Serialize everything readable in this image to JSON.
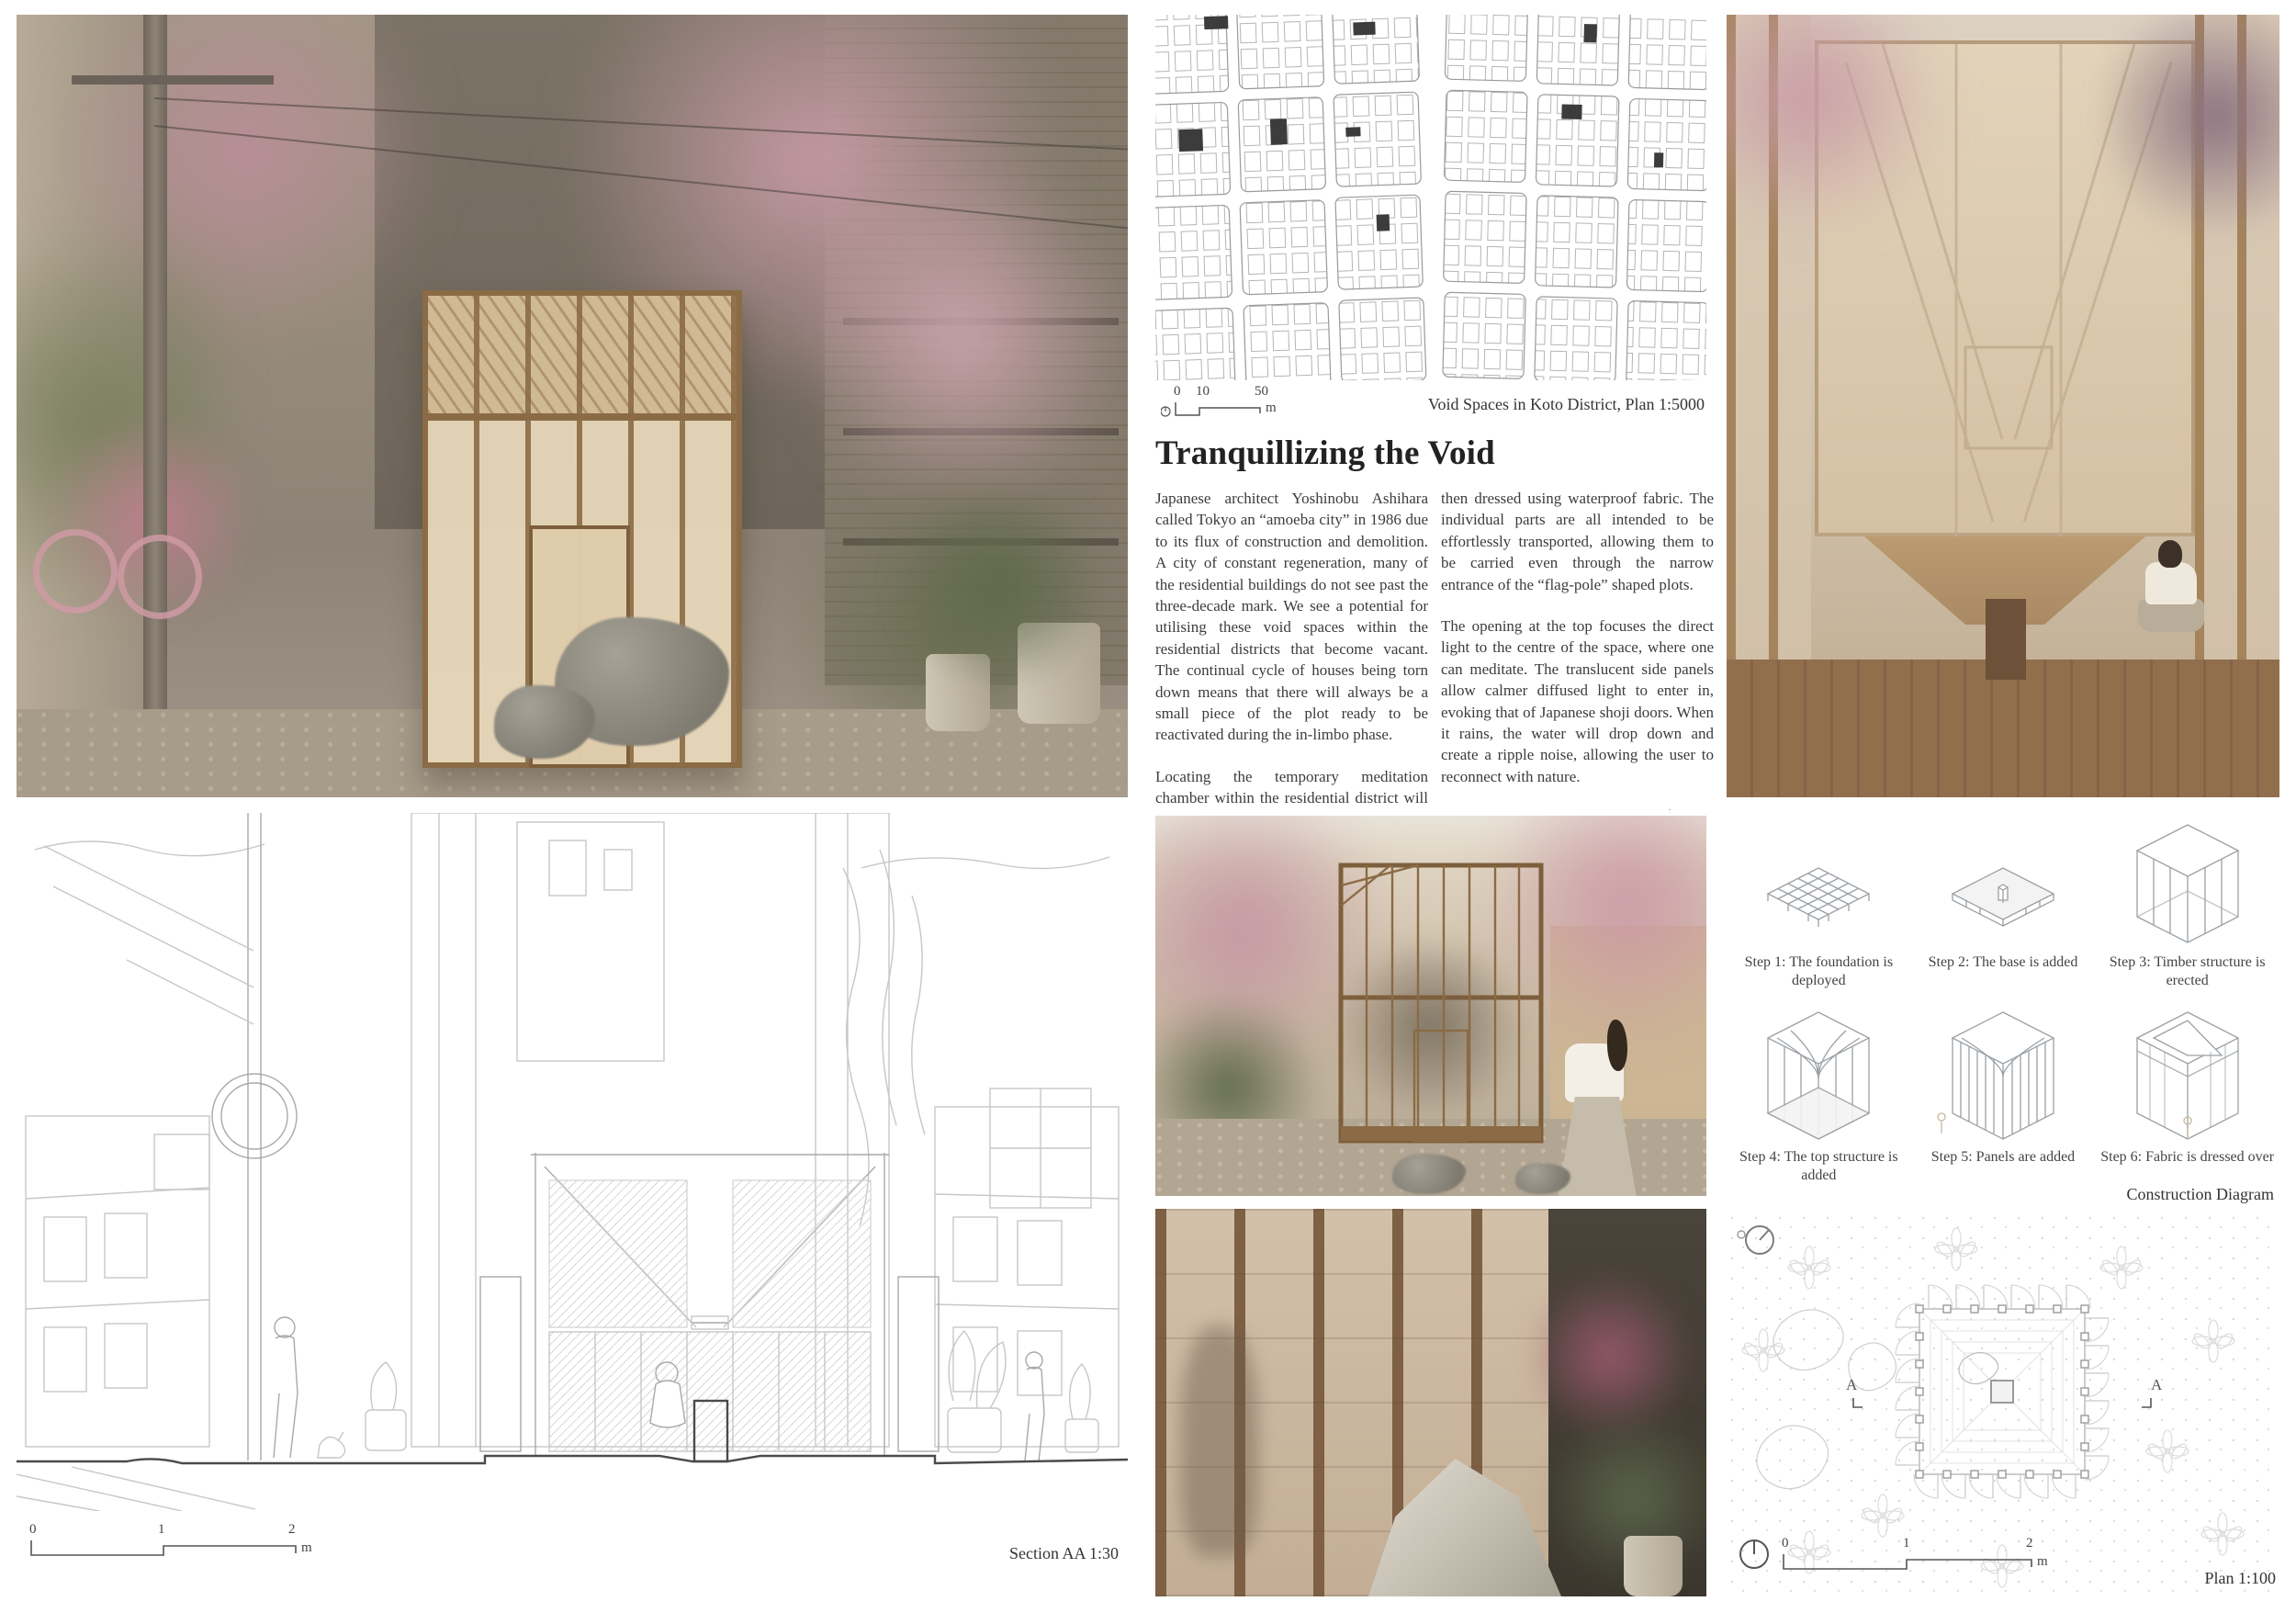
{
  "article": {
    "title": "Tranquillizing the Void",
    "col1": {
      "p1": "Japanese architect Yoshinobu Ashihara called Tokyo an “amoeba city” in 1986 due to its flux of construction and demolition. A city of constant regeneration, many of the residential buildings do not see past the three-decade mark. We see a potential for utilising these void spaces within the residential districts that become vacant. The continual cycle of houses being torn down means that there will always be a small piece of the plot ready to be reactivated during the in-limbo phase.",
      "p2": "Locating the temporary meditation chamber within the residential district will allow Tokyo’s hard-working “salarymen” to reflect and find themselves on their way back from work or during their off days.",
      "p3": "Our design mimics that of a traditional Japanese lantern. The modest temporary timber structure is easily assembled with Japanese joinery and"
    },
    "col2": {
      "p1": "then dressed using waterproof fabric. The individual parts are all intended to be effortlessly transported, allowing them to be carried even through the narrow entrance of the “flag-pole” shaped plots.",
      "p2": "The opening at the top focuses the direct light to the centre of the space, where one can meditate. The translucent side panels allow calmer diffused light to enter in, evoking that of Japanese shoji doors. When it rains, the water will drop down and create a ripple noise, allowing the user to reconnect with nature.",
      "p3": "Playing with the concept of Oku (奥), our simple yet thought-provoking proposal layers the separation with the outside and draws attention to the centre of the chamber. This aims to create a calm detachment from the stressful environment and rewire the user’s mind to within."
    }
  },
  "map": {
    "caption": "Void Spaces in Koto District, Plan 1:5000",
    "scale": {
      "t0": "0",
      "t1": "10",
      "t2": "50",
      "unit": "m"
    }
  },
  "construction": {
    "caption": "Construction Diagram",
    "steps": [
      {
        "label": "Step 1: The foundation is deployed"
      },
      {
        "label": "Step 2: The base is added"
      },
      {
        "label": "Step 3: Timber structure is erected"
      },
      {
        "label": "Step 4: The top structure is added"
      },
      {
        "label": "Step 5: Panels are added"
      },
      {
        "label": "Step 6: Fabric is dressed over"
      }
    ]
  },
  "section": {
    "caption": "Section AA 1:30",
    "scale": {
      "t0": "0",
      "t1": "1",
      "t2": "2",
      "unit": "m"
    }
  },
  "plan": {
    "caption": "Plan 1:100",
    "marker": "A",
    "scale": {
      "t0": "0",
      "t1": "1",
      "t2": "2",
      "unit": "m"
    }
  },
  "palette": {
    "blossom_pink": "#c59aa3",
    "timber": "#8a6b45",
    "fabric_beige": "#dccab0",
    "line_grey": "#c7c7c7",
    "ink": "#3c3c3c"
  }
}
